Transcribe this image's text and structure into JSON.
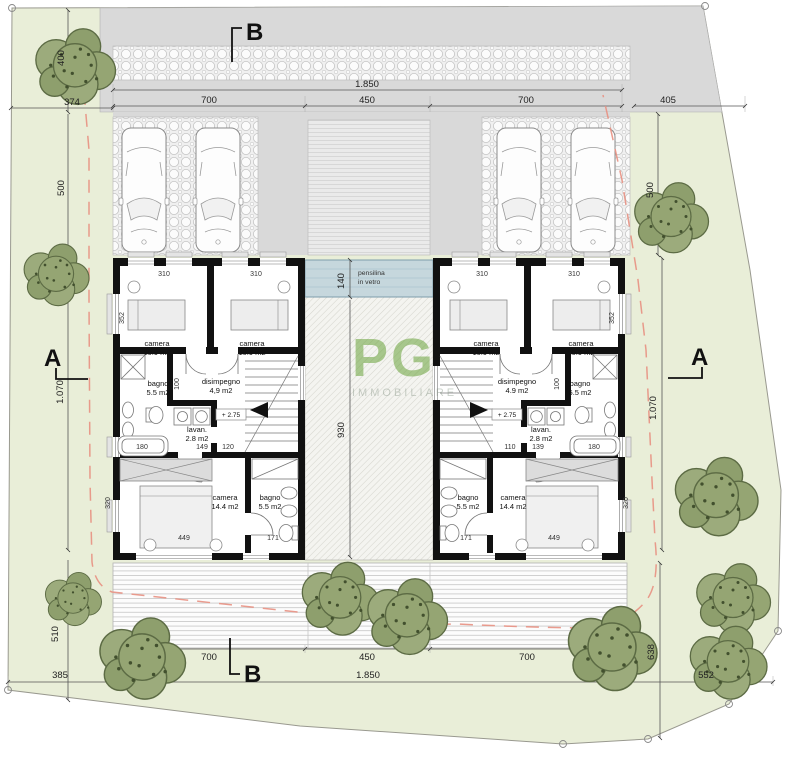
{
  "drawing": {
    "type_label": "site-and-floor-plan",
    "watermark": {
      "main": "PG",
      "sub": "IMMOBILIARE"
    },
    "sections": {
      "a": "A",
      "b": "B"
    },
    "canopy": {
      "line1": "pensilina",
      "line2": "in vetro"
    },
    "colors": {
      "site_fill": "#e9eed8",
      "road_fill": "#d9d9d9",
      "canopy_fill": "#c6d7dd",
      "wall": "#111111",
      "boundary_red_dashed": "#e89082",
      "tree_green": "#95a573",
      "watermark_green": "#6aa33b"
    }
  },
  "units": {
    "left": {
      "camera1_name": "camera",
      "camera1_area": "10.9 m2",
      "camera2_name": "camera",
      "camera2_area": "10.9 m2",
      "bagno1_name": "bagno",
      "bagno1_area": "5.5 m2",
      "disimpegno_name": "disimpegno",
      "disimpegno_area": "4,9 m2",
      "lavanderia_name": "lavan.",
      "lavanderia_area": "2.8 m2",
      "camera3_name": "camera",
      "camera3_area": "14.4 m2",
      "bagno2_name": "bagno",
      "bagno2_area": "5.5 m2",
      "level": "+ 2.75",
      "dims": {
        "w1": "310",
        "w2": "310",
        "h1": "352",
        "hall": "100",
        "tub": "180",
        "d1": "149",
        "d2": "120",
        "bed": "449",
        "h2": "320",
        "tub2": "171"
      }
    },
    "right": {
      "camera1_name": "camera",
      "camera1_area": "10.9 m2",
      "camera2_name": "camera",
      "camera2_area": "10.9 m2",
      "bagno1_name": "bagno",
      "bagno1_area": "5.5 m2",
      "disimpegno_name": "disimpegno",
      "disimpegno_area": "4.9 m2",
      "lavanderia_name": "lavan.",
      "lavanderia_area": "2.8 m2",
      "camera3_name": "camera",
      "camera3_area": "14.4 m2",
      "bagno2_name": "bagno",
      "bagno2_area": "5.5 m2",
      "level": "+ 2.75",
      "dims": {
        "w1": "310",
        "w2": "310",
        "h1": "352",
        "hall": "100",
        "d1": "110",
        "d2": "139",
        "tub": "180",
        "bed": "449",
        "tub2": "171",
        "h2": "320"
      }
    }
  },
  "site_dims": {
    "top_400": "400",
    "top_374": "374",
    "top_1850": "1.850",
    "top_700_left": "700",
    "top_450": "450",
    "top_700_right": "700",
    "top_405": "405",
    "left_500": "500",
    "right_500": "500",
    "left_1070": "1.070",
    "right_1070": "1.070",
    "canopy_140": "140",
    "court_930": "930",
    "bottom_510": "510",
    "bottom_385": "385",
    "bottom_700_left": "700",
    "bottom_450": "450",
    "bottom_700_right": "700",
    "bottom_1850": "1.850",
    "right_638": "638",
    "bottom_552": "552"
  }
}
